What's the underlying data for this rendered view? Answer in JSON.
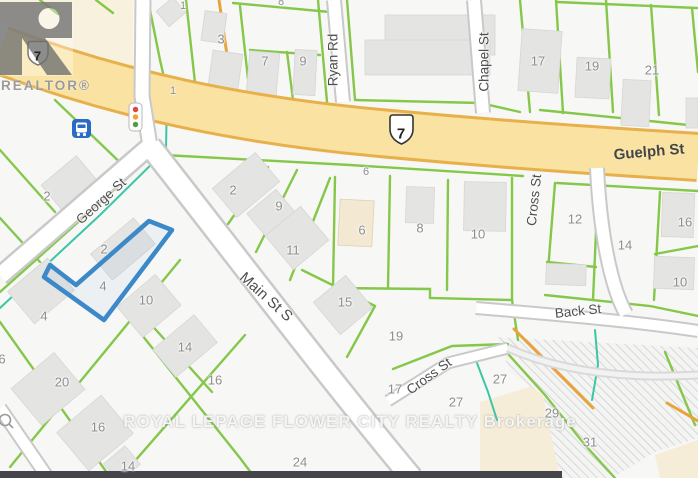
{
  "streets": {
    "guelph": "Guelph St",
    "george": "George St",
    "main": "Main St S",
    "ryan": "Ryan Rd",
    "chapel": "Chapel St",
    "cross_north": "Cross St",
    "cross_south": "Cross St",
    "back": "Back St"
  },
  "route_shields": {
    "west": "7",
    "center": "7"
  },
  "address_marker": "1",
  "lots": [
    "1",
    "8",
    "3",
    "7",
    "9",
    "17",
    "19",
    "21",
    "2",
    "9",
    "11",
    "6",
    "6",
    "8",
    "10",
    "12",
    "14",
    "16",
    "10",
    "15",
    "19",
    "2",
    "2",
    "4",
    "10",
    "4",
    "20",
    "14",
    "16",
    "6",
    "16",
    "14",
    "24",
    "17",
    "27",
    "27",
    "29",
    "31"
  ],
  "watermarks": {
    "logo_text": "REALTOR®",
    "brokerage": "ROYAL LEPAGE FLOWER CITY REALTY Brokerage"
  },
  "icons": {
    "traffic_light": "traffic-light-icon",
    "bus_stop": "bus-stop-icon",
    "highway_shield": "highway-7-shield-icon",
    "cul_de_sac": "circle-marker-icon",
    "realtor_logo": "realtor-r-logo-icon"
  },
  "colors": {
    "highway_fill": "#f9e2a2",
    "highway_casing": "#e8b04a",
    "parcel_line_green": "#7fc542",
    "boundary_teal": "#3cc6a6",
    "utility_orange": "#e8a33d",
    "highlight_parcel_blue": "#3c89c9",
    "road_fill": "#ffffff",
    "road_casing": "#c9c9c9",
    "building_gray": "#e4e4e2",
    "building_poi_beige": "#f3e8d2",
    "cream_area": "#f7f1dd",
    "hatch_gray": "#c9ccd1",
    "dark_band": "#43454a",
    "bus_icon_blue": "#2a6cc4"
  }
}
